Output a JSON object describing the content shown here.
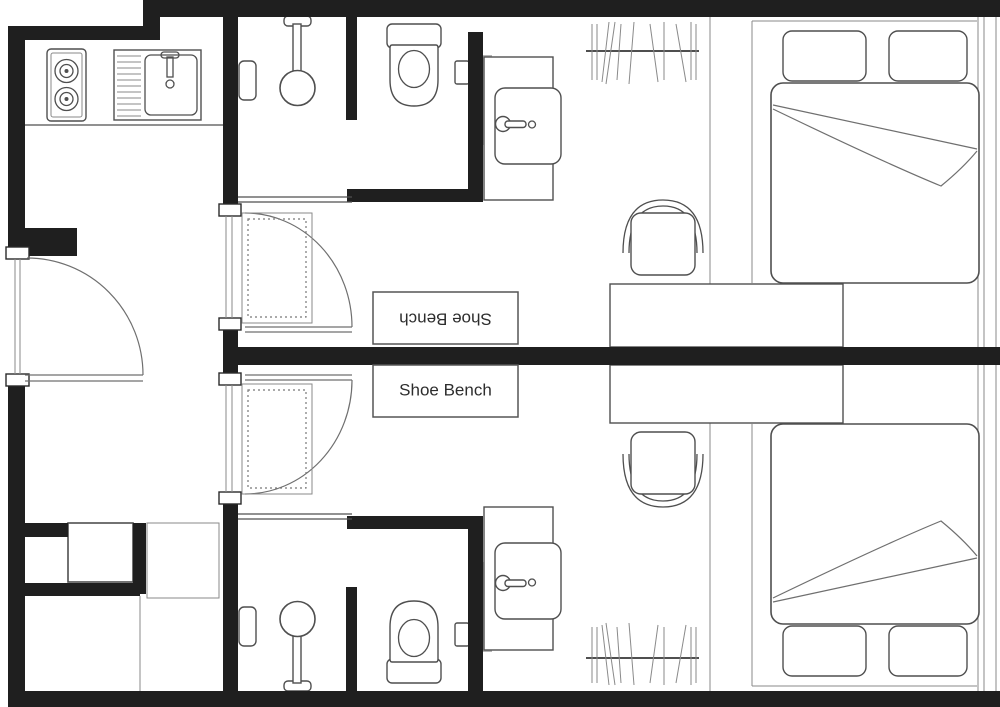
{
  "title": "Two mirrored guest-room units floor plan",
  "labels": {
    "shoe_bench_top": "Shoe Bench",
    "shoe_bench_bottom": "Shoe Bench"
  },
  "colors": {
    "wall": "#1f1f1f",
    "line": "#4f4f4f",
    "light_line": "#8a8a8a",
    "panel_gray": "#b5b5b5",
    "text": "#2d2d2d",
    "background": "#ffffff"
  },
  "corridor": {
    "fixtures": [
      "entry-door",
      "two-burner-stove",
      "kitchen-sink-with-drainboard",
      "washer-space",
      "fridge-space"
    ]
  },
  "units": {
    "upper": {
      "shoe_bench_label": "Shoe Bench",
      "fixtures": [
        "suite-door",
        "entry-mat",
        "shoe-bench",
        "shower-head",
        "shower-shelf",
        "toilet",
        "toilet-paper-holder",
        "vanity-sink",
        "hanging-closet",
        "double-bed",
        "pillows",
        "desk",
        "chair"
      ]
    },
    "lower": {
      "shoe_bench_label": "Shoe Bench",
      "fixtures": [
        "suite-door",
        "entry-mat",
        "shoe-bench",
        "shower-head",
        "shower-shelf",
        "toilet",
        "toilet-paper-holder",
        "vanity-sink",
        "hanging-closet",
        "double-bed",
        "pillows",
        "desk",
        "chair"
      ]
    }
  }
}
